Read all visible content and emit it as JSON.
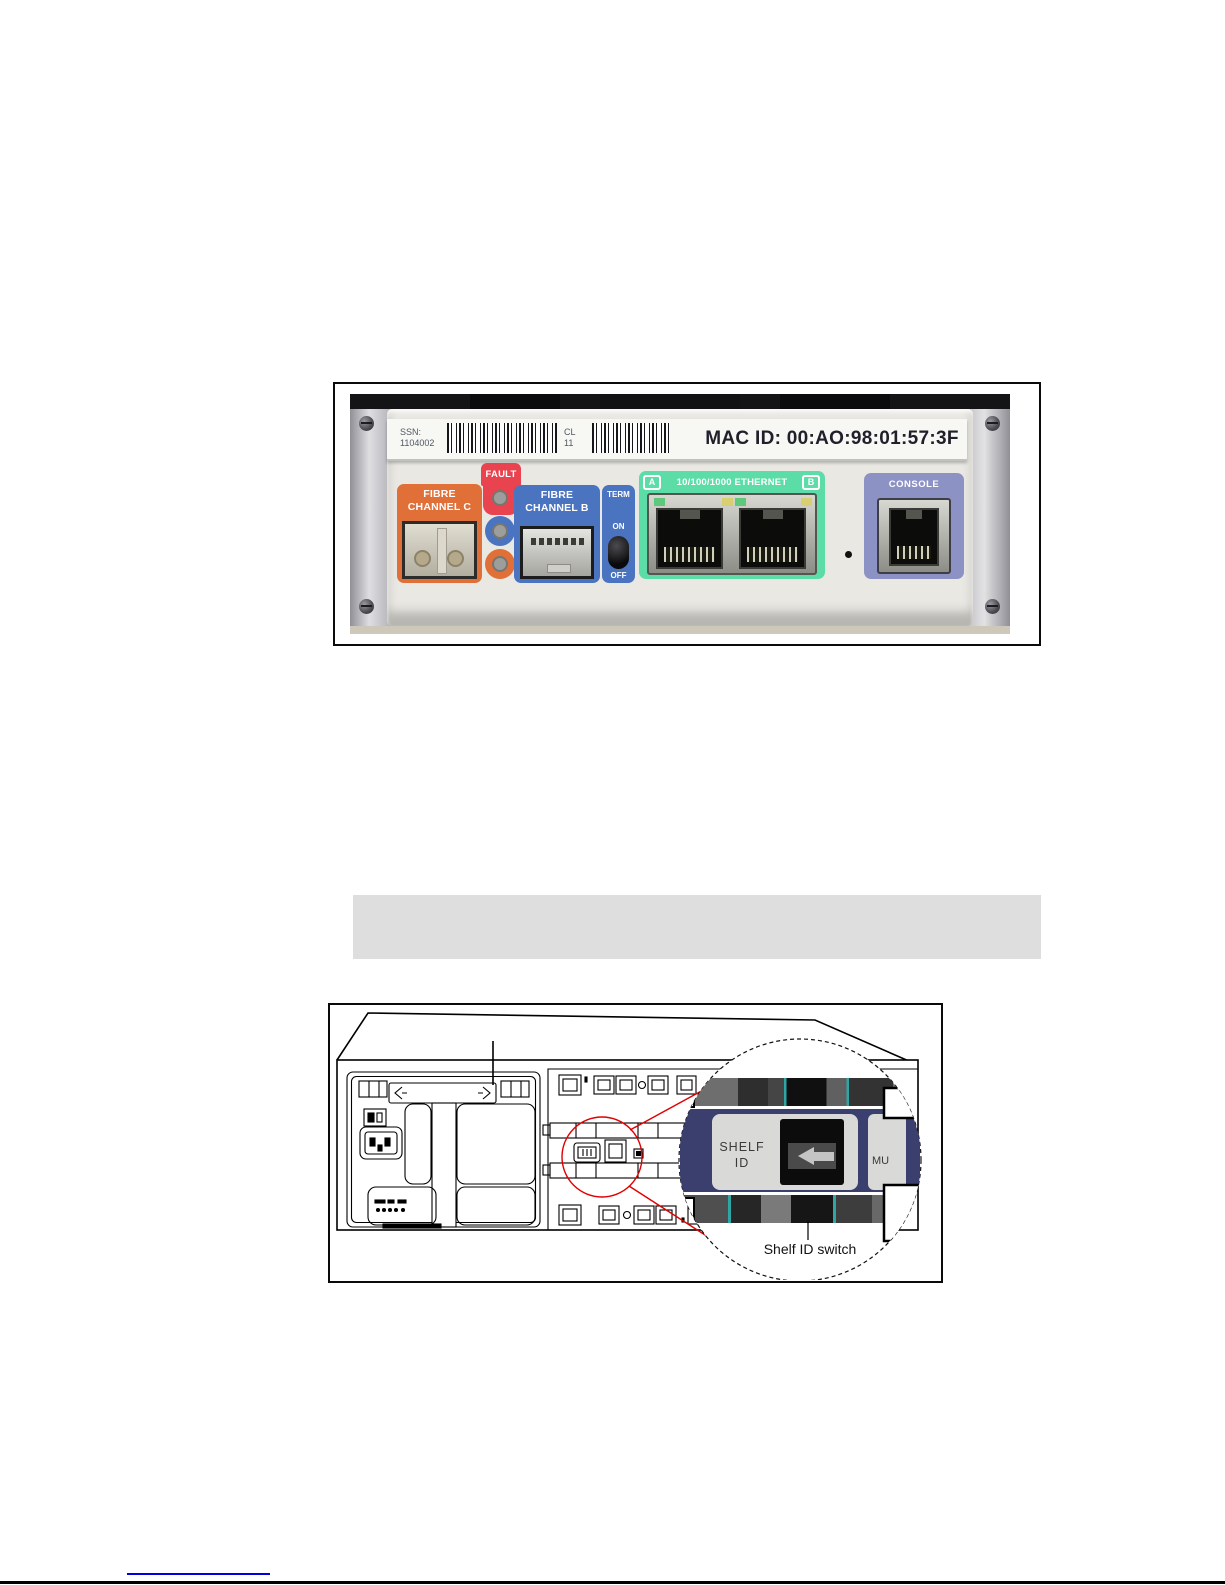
{
  "figure1": {
    "label_strip": {
      "ssn_label": "SSN:",
      "ssn_value": "1104002",
      "cl_label": "CL",
      "cl_value": "11",
      "mac_id": "MAC ID: 00:AO:98:01:57:3F"
    },
    "fault": {
      "label": "FAULT"
    },
    "fibre_channel_c": {
      "line1": "FIBRE",
      "line2": "CHANNEL C"
    },
    "fibre_channel_b": {
      "line1": "FIBRE",
      "line2": "CHANNEL B"
    },
    "term_switch": {
      "label": "TERM",
      "on": "ON",
      "off": "OFF"
    },
    "ethernet": {
      "port_a": "A",
      "label": "10/100/1000 ETHERNET",
      "port_b": "B"
    },
    "console": {
      "label": "CONSOLE"
    },
    "colors": {
      "fault_red": "#e8434f",
      "fibre_orange": "#e06f38",
      "fibre_blue": "#4a74c0",
      "ethernet_green": "#5cdca6",
      "console_purple": "#8d92c4"
    }
  },
  "note_box": {
    "background": "#dedede"
  },
  "figure2": {
    "zoom_view": {
      "shelf_id_line1": "SHELF",
      "shelf_id_line2": "ID",
      "adjacent_partial": "MU"
    },
    "caption": "Shelf ID switch",
    "highlight_color": "#e00000"
  },
  "footer": {
    "link_color": "#0000dd"
  }
}
